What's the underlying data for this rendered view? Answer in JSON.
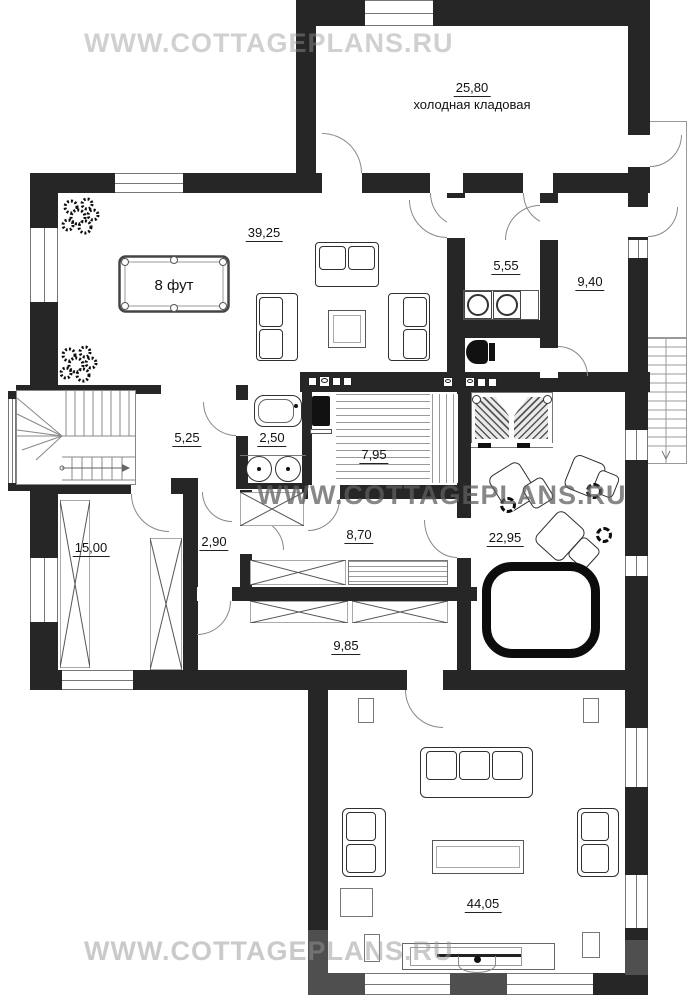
{
  "watermark": {
    "text": "WWW.COTTAGEPLANS.RU"
  },
  "rooms": {
    "cold_storage": {
      "area": "25,80",
      "name": "холодная кладовая"
    },
    "billiard_room": {
      "area": "39,25"
    },
    "pool_table": {
      "label": "8 фут"
    },
    "laundry": {
      "area": "5,55"
    },
    "back_hall": {
      "area": "9,40"
    },
    "stair_hall": {
      "area": "5,25"
    },
    "bathroom": {
      "area": "2,50"
    },
    "sauna": {
      "area": "7,95"
    },
    "corridor": {
      "area": "2,90"
    },
    "rest_room": {
      "area": "8,70"
    },
    "storage_room": {
      "area": "15,00"
    },
    "spa_room": {
      "area": "22,95"
    },
    "lounge": {
      "area": "9,85"
    },
    "living_room": {
      "area": "44,05"
    }
  },
  "colors": {
    "wall": "#262626",
    "wall_gray": "#4f4f4f",
    "watermark_light": "#c9c9c9",
    "watermark_dark": "#8a8a8a",
    "furniture_line": "#2f2f2f"
  }
}
